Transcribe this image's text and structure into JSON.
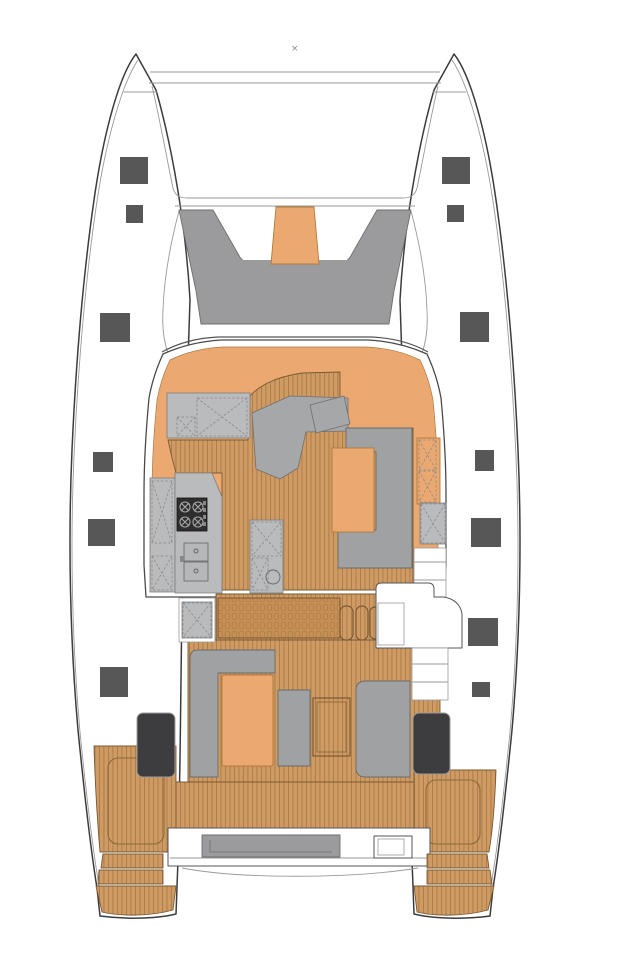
{
  "figure": {
    "marker_glyph": "×"
  },
  "colors": {
    "hull_outline": "#3c3c3c",
    "line_soft": "#9a9a9a",
    "hatch": "#575757",
    "deck_gray": "#9b9b9d",
    "mid_gray": "#a5a7a9",
    "sofa_gray": "#9fa1a3",
    "counter_gray": "#b9bbbd",
    "accent": "#eba971",
    "accent_line": "#b07a3a",
    "wood": "#cf9a63",
    "wood_line": "#a97c46",
    "wood_slat": "#c68f55",
    "wood_edge": "#7a5a34",
    "dark_seat": "#3d3d3f",
    "stove": "#2e2e2e"
  }
}
